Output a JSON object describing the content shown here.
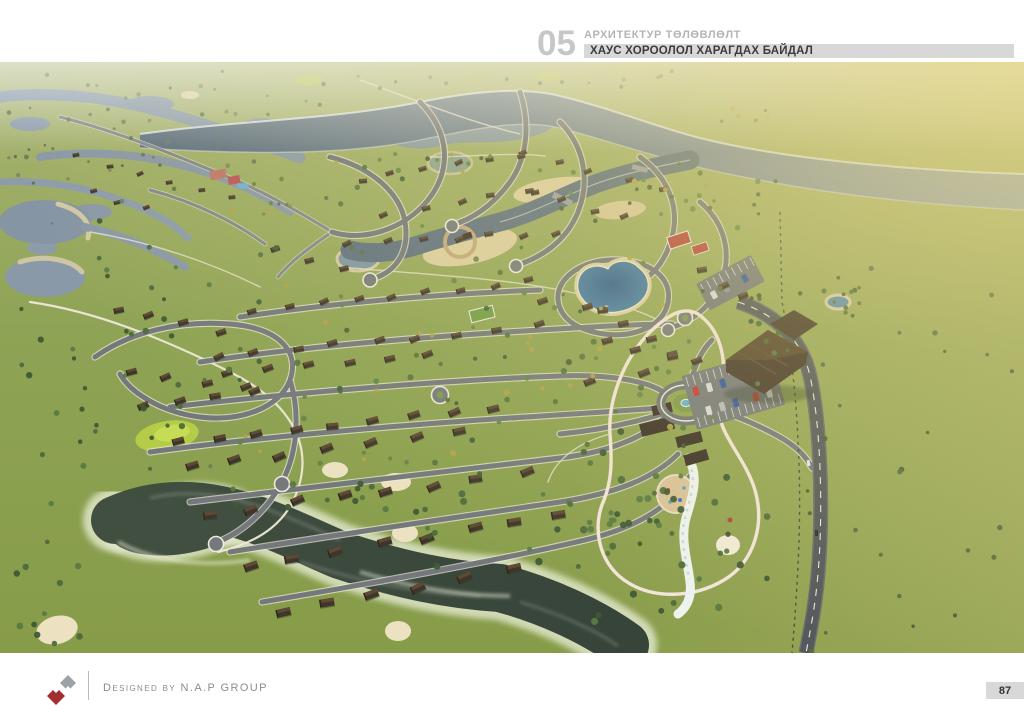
{
  "header": {
    "section_number": "05",
    "section_label": "АРХИТЕКТУР ТӨЛӨВЛӨЛТ",
    "page_title": "ХАУС ХОРООЛОЛ ХАРАГДАХ БАЙДАЛ"
  },
  "render": {
    "alt": "Aerial 3D render of the house district master plan: winding river with sandy beaches, heart-shaped pond, curving residential streets with cottages, clubhouse with parking, roundabout fountain, water-play area, dark lake and golf meadows, highway on the east side"
  },
  "footer": {
    "credit": "Designed by N.A.P GROUP",
    "page_number": "87"
  },
  "colors": {
    "header_num": "#c7c7c7",
    "header_sub": "#b4b4b4",
    "header_bar": "#d8d8d8",
    "header_title": "#3b3b3b",
    "footer_text": "#8c8c8c",
    "page_badge": "#d8d8d8",
    "logo_red": "#a12f2f",
    "logo_gray": "#9ba3a9",
    "grass_green": "#8ca050",
    "river_blue": "#66788a",
    "lake_dark": "#3d4a3b",
    "sand_beige": "#dccfa2",
    "road_gray": "#74787b",
    "roof_brown": "#40352a",
    "pond_blue": "#3e719c"
  }
}
